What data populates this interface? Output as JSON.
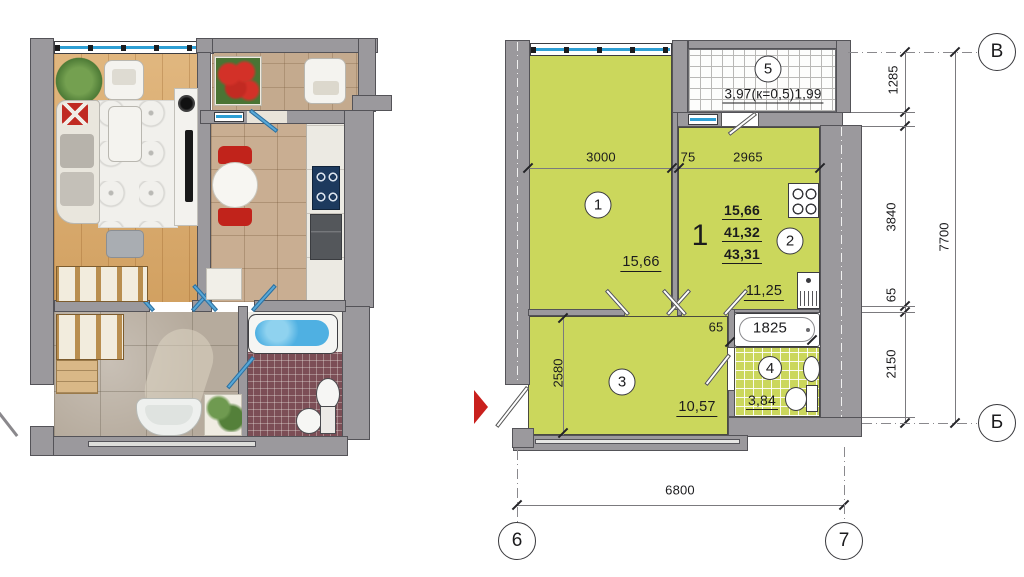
{
  "title": "apartment-floor-plan",
  "colors": {
    "room_fill": "#cbd75c",
    "wall_gray": "#9b999d",
    "window_blue": "#2e9fd4",
    "entry_arrow_red": "#c9201d"
  },
  "right_plan": {
    "apartment": {
      "count": "1",
      "living_area": "15,66",
      "heated_area": "41,32",
      "total_area": "43,31"
    },
    "rooms": {
      "r1": {
        "num": "1",
        "area": "15,66"
      },
      "r2": {
        "num": "2",
        "area": "11,25"
      },
      "r3": {
        "num": "3",
        "area": "10,57"
      },
      "r4": {
        "num": "4",
        "area": "3,84"
      },
      "r5": {
        "num": "5",
        "area": "3,97(к=0,5)1,99"
      }
    },
    "dims": {
      "w1": "3000",
      "w2": "75",
      "w3": "2965",
      "h1": "1285",
      "h2": "3840",
      "h3": "65",
      "h4": "2150",
      "h_total": "7700",
      "hall_h": "2580",
      "bath_wall": "65",
      "bath_len": "1825",
      "bottom": "6800"
    },
    "grid": {
      "top_right": "В",
      "bottom_right": "Б",
      "col_left": "6",
      "col_right": "7"
    }
  }
}
